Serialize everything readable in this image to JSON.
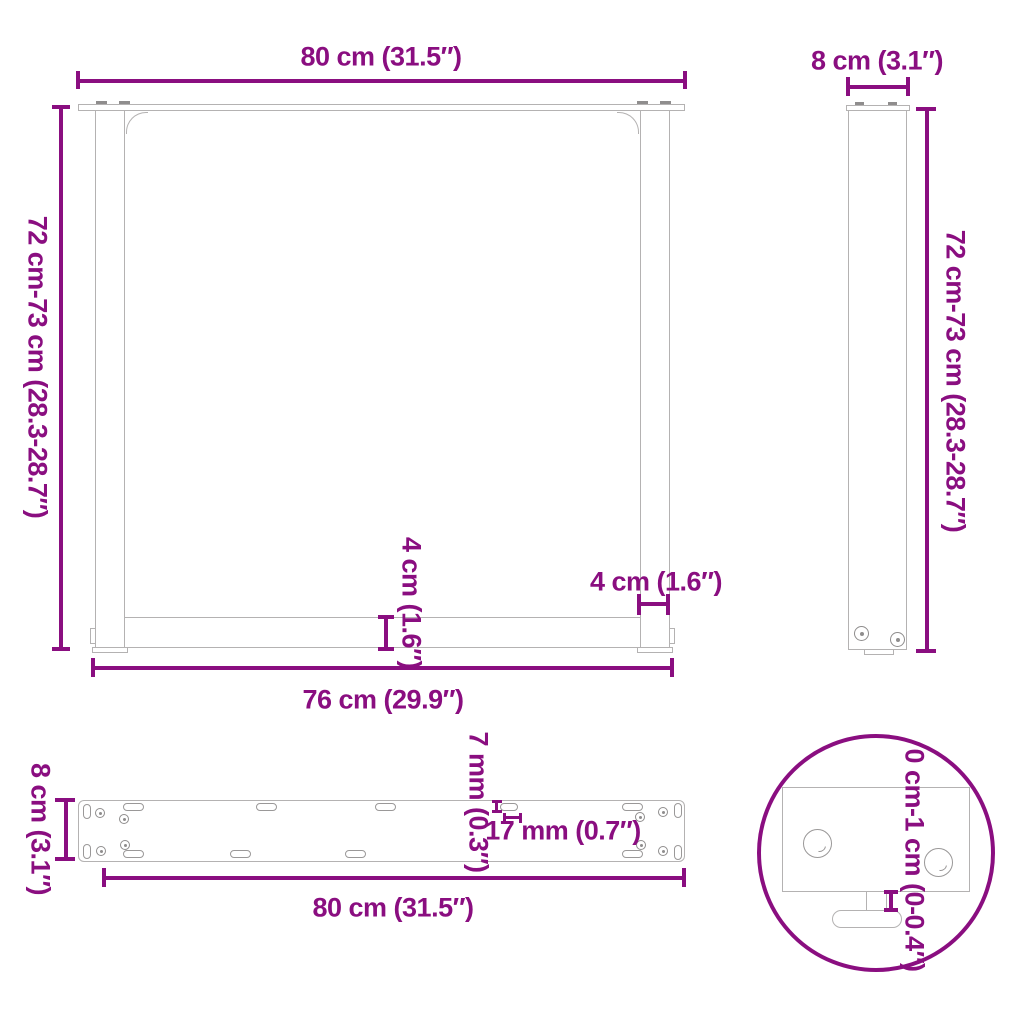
{
  "title": "table-leg-dimension-diagram",
  "colors": {
    "accent": "#8A0E80",
    "drawing_line": "#B4B2B2"
  },
  "front_view": {
    "top_width_label": "80 cm (31.5″)",
    "height_label": "72 cm-73 cm (28.3-28.7″)",
    "crossbar_height_label": "4 cm (1.6″)",
    "leg_width_label": "4 cm (1.6″)",
    "inner_width_label": "76 cm (29.9″)"
  },
  "side_view": {
    "depth_label": "8 cm (3.1″)",
    "height_label": "72 cm-73 cm (28.3-28.7″)"
  },
  "top_view": {
    "depth_label": "8 cm (3.1″)",
    "hole_width_label": "7 mm (0.3″)",
    "hole_length_label": "17 mm (0.7″)",
    "length_label": "80 cm (31.5″)"
  },
  "detail_view": {
    "foot_adjustment_label": "0 cm-1 cm (0-0.4″)"
  }
}
